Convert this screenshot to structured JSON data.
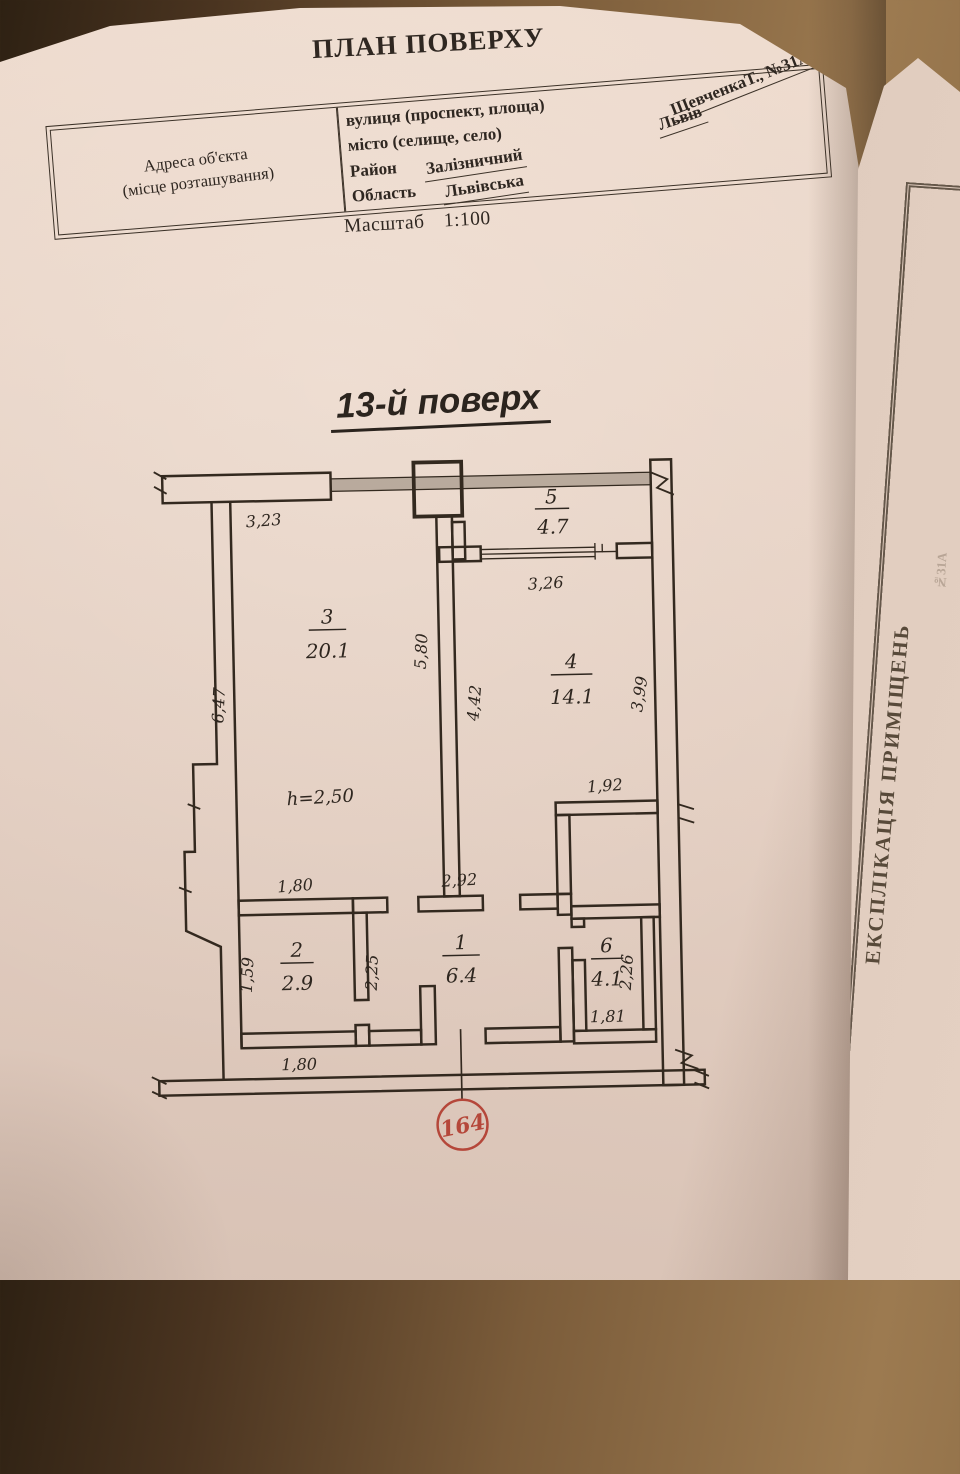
{
  "header": {
    "title": "ПЛАН ПОВЕРХУ",
    "scale_label": "Масштаб",
    "scale_value": "1:100",
    "floor_title": "13-й поверх"
  },
  "address_table": {
    "left_cell_line1": "Адреса об'єкта",
    "left_cell_line2": "(місце розташування)",
    "rows": [
      {
        "label": "вулиця (проспект, площа)",
        "value": "ШевченкаТ., №31А"
      },
      {
        "label": "місто (селище, село)",
        "value": "Львів"
      },
      {
        "label": "Район",
        "value": "Залізничний"
      },
      {
        "label": "Область",
        "value": "Львівська"
      }
    ]
  },
  "plan": {
    "rooms": [
      {
        "num": "1",
        "area": "6.4"
      },
      {
        "num": "2",
        "area": "2.9"
      },
      {
        "num": "3",
        "area": "20.1"
      },
      {
        "num": "4",
        "area": "14.1"
      },
      {
        "num": "5",
        "area": "4.7"
      },
      {
        "num": "6",
        "area": "4.1"
      }
    ],
    "height_label": "h=2,50",
    "stamp": "164",
    "dims": {
      "top": "3,23",
      "balcony_window": "3,26",
      "room3_left": "6,47",
      "room3_right": "5,80",
      "room4_left": "4,42",
      "room4_right": "3,99",
      "room4_niche": "1,92",
      "room2_top": "1,80",
      "room1_top": "2,92",
      "room2_left": "1,59",
      "room1_left": "2,25",
      "room6_right": "2,26",
      "room2_bottom": "1,80",
      "room6_bottom": "1,81"
    },
    "colors": {
      "ink": "#33291f",
      "stamp_red": "#b5473a",
      "glazing_grey": "#8f8474"
    }
  },
  "side_page": {
    "vertical_title": "ЕКСПЛІКАЦІЯ ПРИМІЩЕНЬ",
    "edge_text": "№31А"
  }
}
